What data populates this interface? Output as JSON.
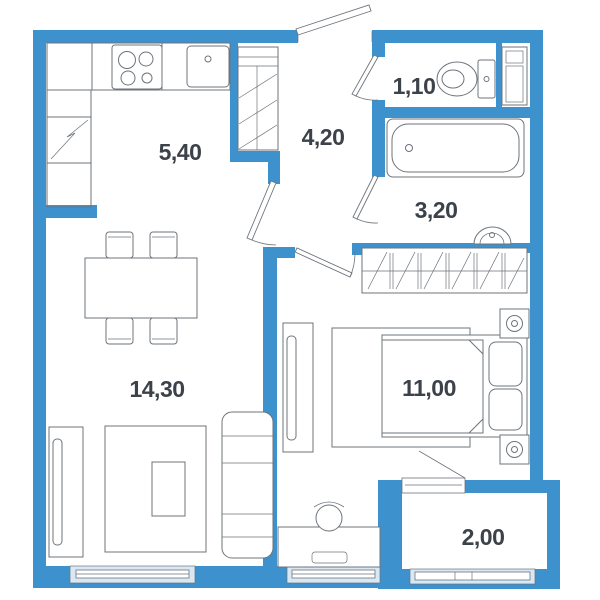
{
  "floor_plan": {
    "type": "apartment-floor-plan",
    "rooms": [
      {
        "name": "kitchen",
        "area_m2": "5,40"
      },
      {
        "name": "hallway",
        "area_m2": "4,20"
      },
      {
        "name": "toilet",
        "area_m2": "1,10"
      },
      {
        "name": "bathroom",
        "area_m2": "3,20"
      },
      {
        "name": "living-room",
        "area_m2": "14,30"
      },
      {
        "name": "bedroom",
        "area_m2": "11,00"
      },
      {
        "name": "balcony",
        "area_m2": "2,00"
      }
    ],
    "fixtures": [
      "kitchen-counter",
      "stove",
      "kitchen-sink",
      "fridge-cabinet",
      "entry-closet",
      "dining-table",
      "dining-chairs",
      "tv-stand",
      "rug",
      "coffee-table",
      "sofa",
      "toilet",
      "washing-machine",
      "bathtub",
      "wash-basin",
      "wardrobe",
      "bed",
      "pillows",
      "nightstands",
      "bedroom-tv-panel",
      "desk",
      "desk-chair",
      "laptop"
    ],
    "colors": {
      "wall": "#3d91cd",
      "window": "#d8e8f4",
      "line": "#6e747b",
      "label": "#3c424a",
      "bg": "#ffffff"
    }
  }
}
